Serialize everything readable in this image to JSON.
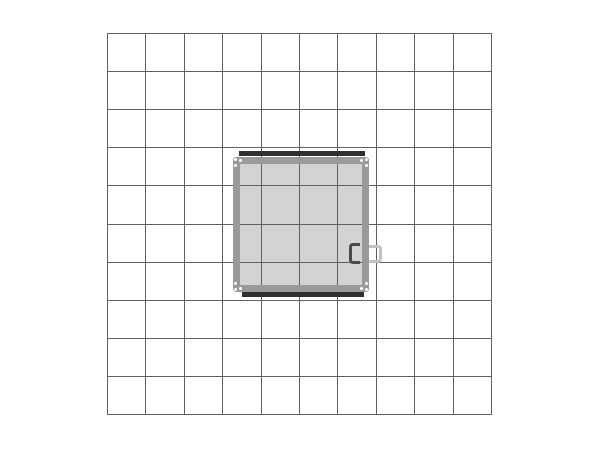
{
  "scene": {
    "kind": "booth-floor-plan"
  },
  "floor_grid": {
    "columns": 10,
    "rows": 10
  },
  "booth": {
    "span_cells": "3.5 x 3.5",
    "corner_fasteners": 4,
    "edge_bars": 2,
    "door_handles": 2
  },
  "colors": {
    "background": "#ffffff",
    "grid_line": "#606060",
    "booth_fill": "#d3d3d3",
    "booth_frame": "#9a9a9a",
    "edge_bar": "#2f2f2f",
    "handle_inner": "#4a4a4a",
    "handle_outer": "#c2c2c2",
    "corner_dot": "#ffffff"
  }
}
